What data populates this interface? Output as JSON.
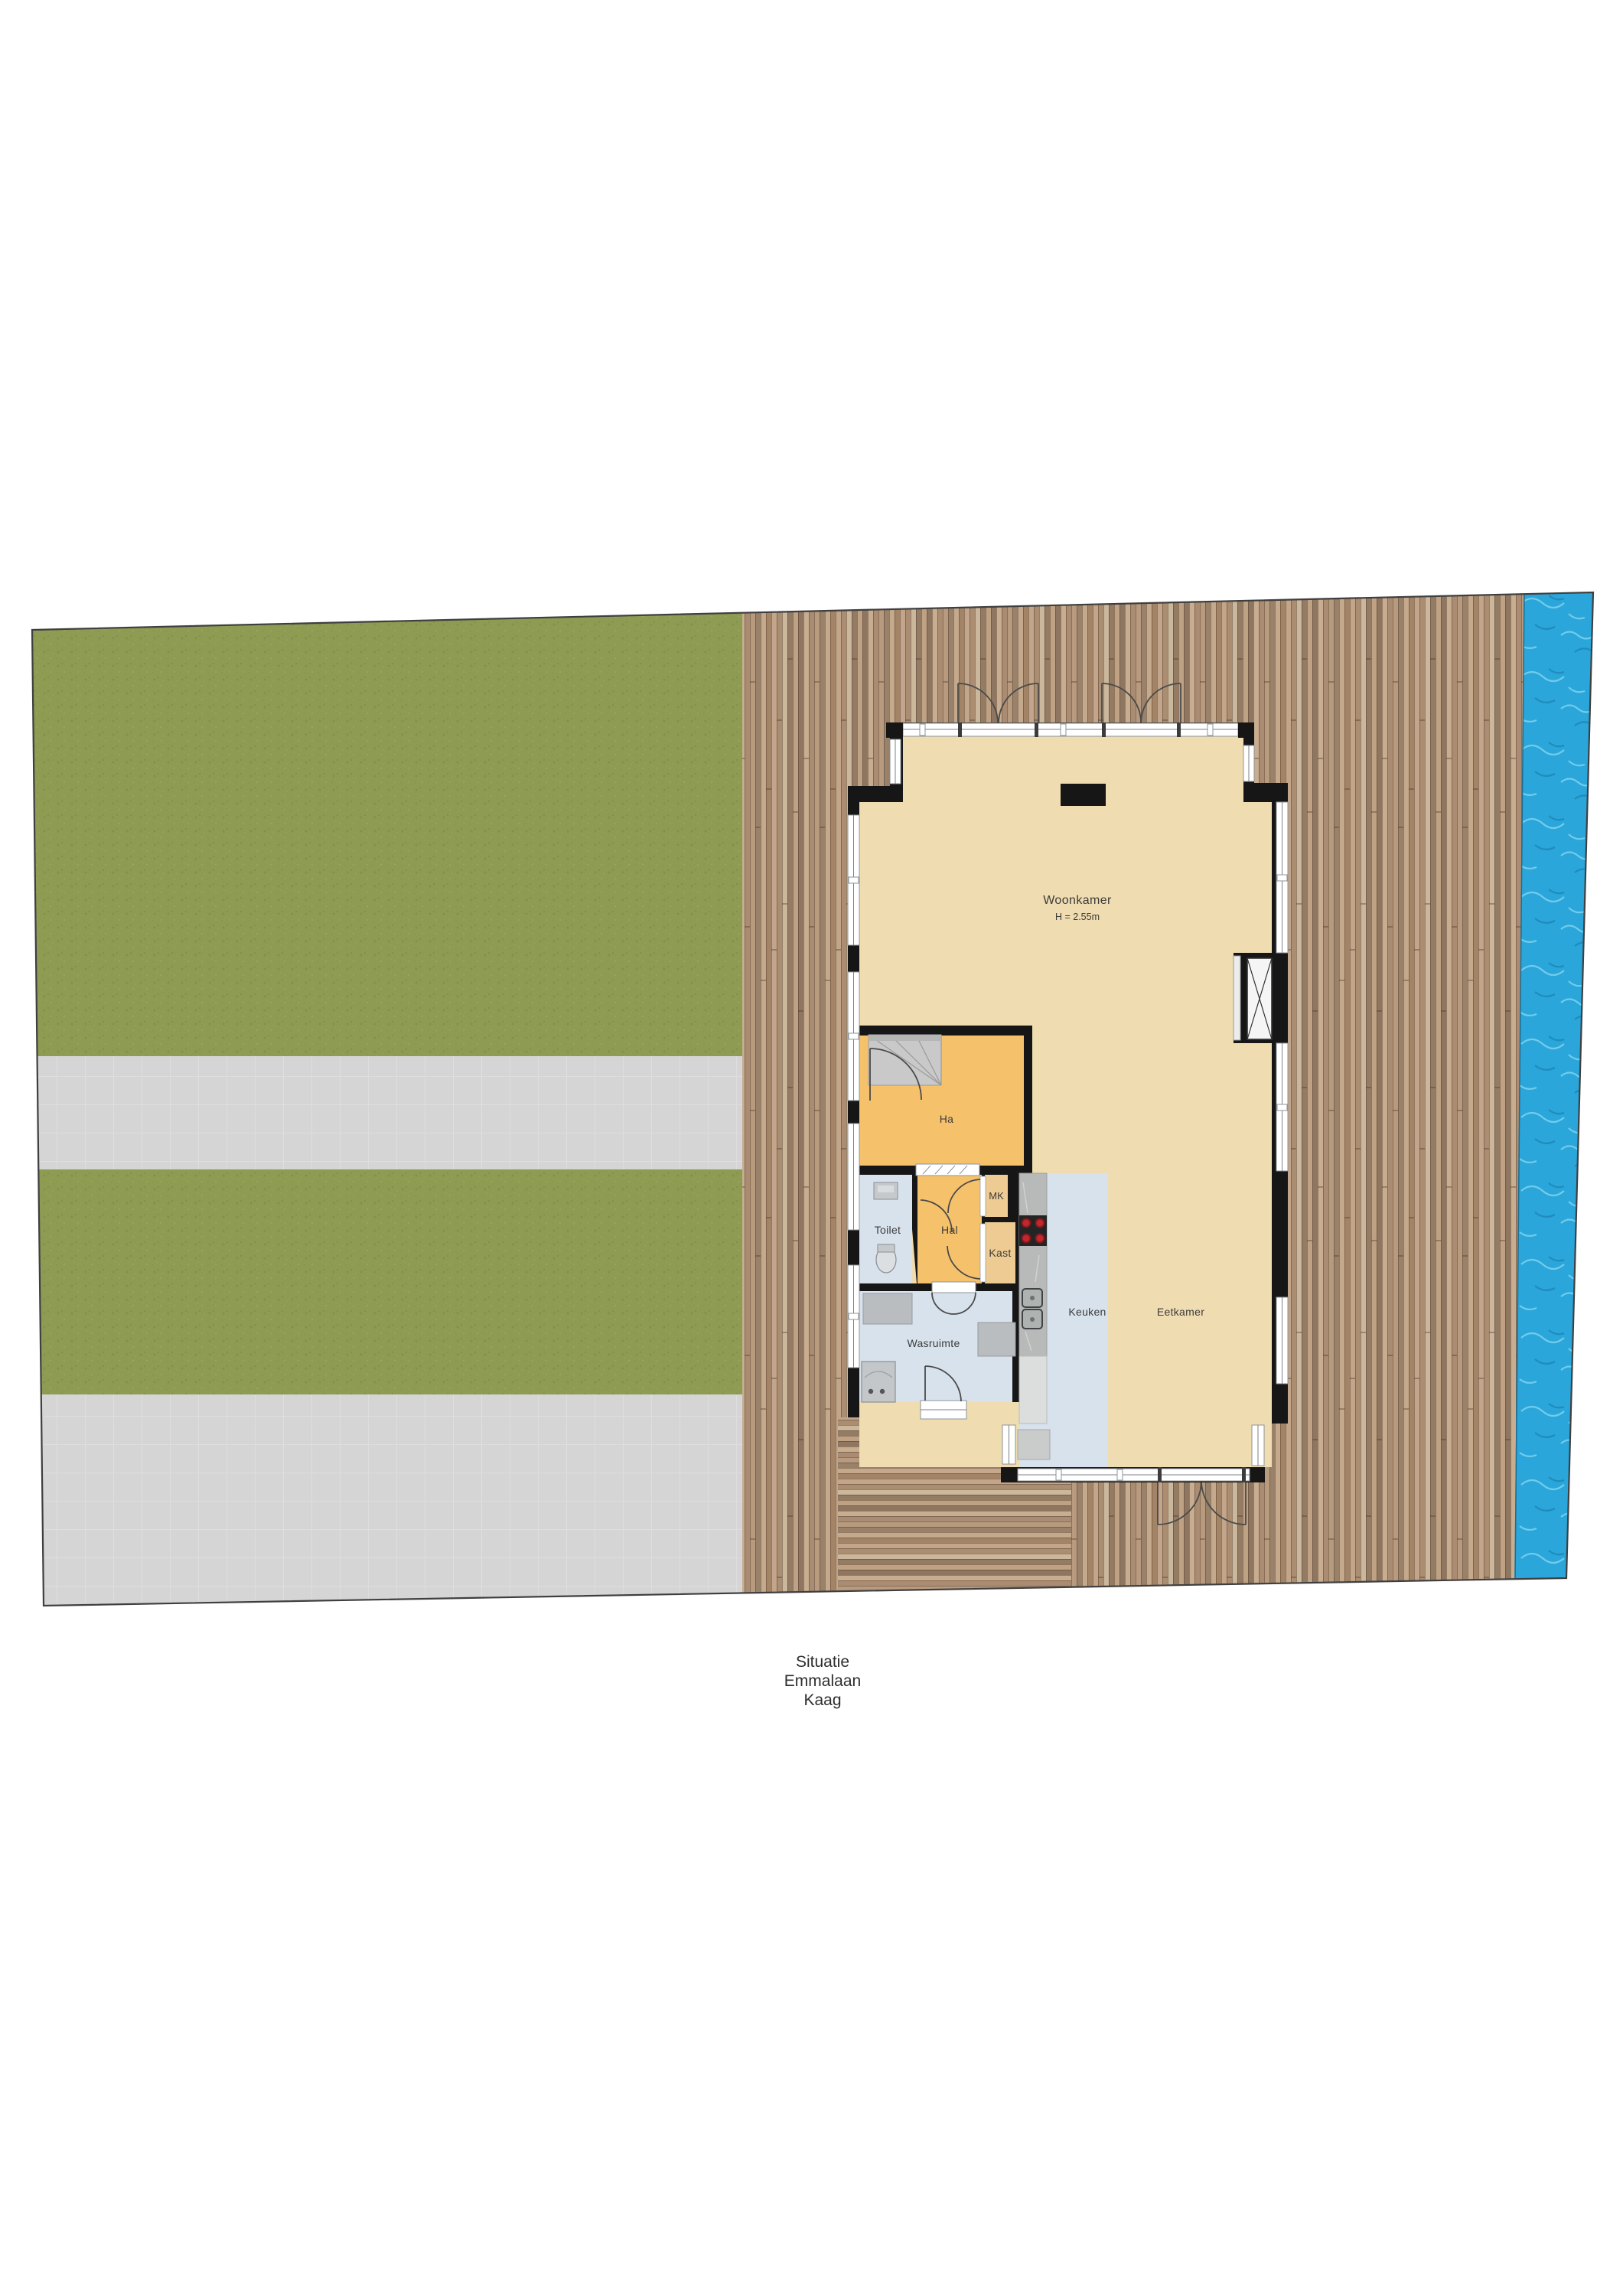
{
  "caption": {
    "line1": "Situatie",
    "line2": "Emmalaan",
    "line3": "Kaag"
  },
  "floorplan": {
    "rooms": [
      {
        "id": "woonkamer",
        "label": "Woonkamer",
        "sublabel": "H = 2.55m"
      },
      {
        "id": "ha",
        "label": "Ha"
      },
      {
        "id": "toilet",
        "label": "Toilet"
      },
      {
        "id": "hal",
        "label": "Hal"
      },
      {
        "id": "mk",
        "label": "MK"
      },
      {
        "id": "kast",
        "label": "Kast"
      },
      {
        "id": "keuken",
        "label": "Keuken"
      },
      {
        "id": "eetkamer",
        "label": "Eetkamer"
      },
      {
        "id": "wasruimte",
        "label": "Wasruimte"
      }
    ],
    "colors": {
      "grass": "#8d9c52",
      "paving": "#d4d5d4",
      "deck": "#b49579",
      "water": "#2aa6da",
      "wall": "#161616",
      "room_tan": "#efdcb0",
      "room_orange": "#f6c16b",
      "room_closet": "#eecb92",
      "room_blue": "#d8e2ed",
      "counter": "#b7bab8",
      "burner": "#c1272d"
    }
  }
}
